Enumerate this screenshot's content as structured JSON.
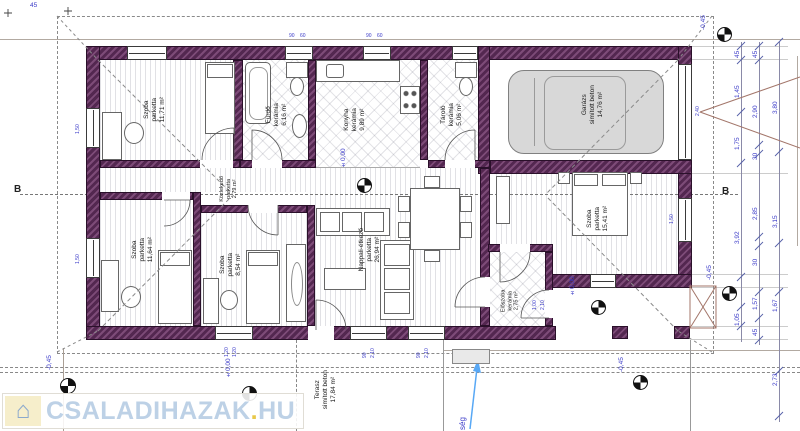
{
  "title": "family house floor plan",
  "watermark": {
    "brand": "CSALADIHAZAK",
    "dot": ".",
    "tld": "HU",
    "icon": "house-icon"
  },
  "rooms": [
    {
      "name": "Szoba",
      "material": "parketta",
      "area": "11,71 m²"
    },
    {
      "name": "Fürdő",
      "material": "kerámia",
      "area": "6,16 m²"
    },
    {
      "name": "Konyha",
      "material": "kerámia",
      "area": "9,89 m²"
    },
    {
      "name": "Tároló",
      "material": "kerámia",
      "area": "5,06 m²"
    },
    {
      "name": "Garázs",
      "material": "simított beton",
      "area": "14,76 m²"
    },
    {
      "name": "Szoba",
      "material": "parketta",
      "area": "11,64 m²"
    },
    {
      "name": "Szoba",
      "material": "parketta",
      "area": "8,54 m²"
    },
    {
      "name": "Közlekedő",
      "material": "parketta",
      "area": "2,79 m²"
    },
    {
      "name": "Nappali-étkező",
      "material": "parketta",
      "area": "26,94 m²"
    },
    {
      "name": "Szoba",
      "material": "parketta",
      "area": "15,41 m²"
    },
    {
      "name": "Előszoba",
      "material": "kerámia",
      "area": "2,75 m²"
    },
    {
      "name": "Terasz",
      "material": "simított beton",
      "area": "17,84 m²"
    }
  ],
  "levels": {
    "zero": "±0,00",
    "minus": "-0,45"
  },
  "section": {
    "label": "B"
  },
  "dimensions": {
    "top_left_offset": "45",
    "right1": [
      "45",
      "1,45",
      "1,75",
      "3,92",
      "1,05"
    ],
    "right2": [
      "45",
      "2,90",
      "30",
      "2,85",
      "30",
      "1,57",
      "45"
    ],
    "right3": [
      "3,80",
      "3,15",
      "1,67",
      "2,73"
    ]
  },
  "opening_labels": {
    "w90": "90",
    "w60": "60",
    "h210": "2,10",
    "w120": "1,20",
    "w150": "1,50",
    "w100": "1,00",
    "garage": "2,40"
  },
  "note_fragment": "ség",
  "colors": {
    "wall": "#532750",
    "dimension_text": "#3a3ac8",
    "watermark_blue": "#bdd1e6",
    "watermark_yellow": "#e8c84a"
  }
}
